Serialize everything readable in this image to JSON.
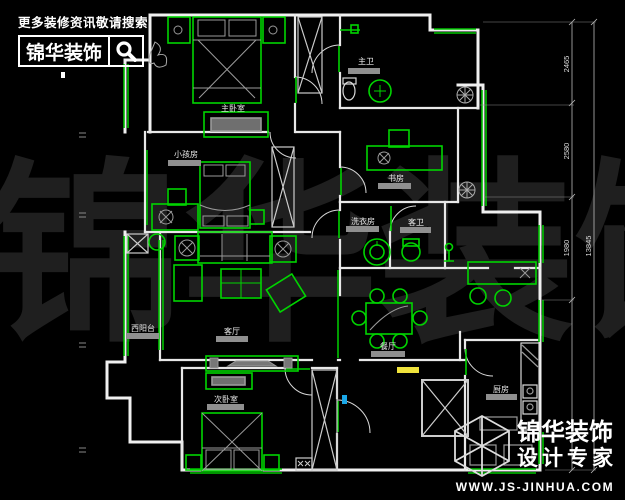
{
  "header": {
    "tagline": "更多装修资讯敬请搜索",
    "brand": "锦华装饰",
    "search_icon": "magnifier"
  },
  "footer": {
    "brand": "锦华装饰",
    "subtitle": "设计专家",
    "website": "WWW.JS-JINHUA.COM",
    "logo_icon": "wireframe-cube"
  },
  "watermark": {
    "chars": [
      "锦",
      "华",
      "装",
      "饰"
    ]
  },
  "rooms": {
    "master_bedroom": "主卧室",
    "kids_room": "小孩房",
    "master_bath": "主卫",
    "study": "书房",
    "laundry": "洗衣房",
    "guest_bath": "客卫",
    "living": "客厅",
    "west_balcony": "西阳台",
    "dining": "餐厅",
    "second_bedroom": "次卧室",
    "kitchen": "厨房"
  },
  "dimensions": {
    "right_segments": [
      "2465",
      "2580",
      "1980"
    ],
    "right_total": "13845"
  },
  "colors": {
    "background": "#000000",
    "wall": "#f0f0f0",
    "furniture_green": "#00d400",
    "label_bar_gray": "#8f8f8f",
    "highlight_yellow": "#f0e33c",
    "highlight_blue": "#1ba8e8"
  }
}
